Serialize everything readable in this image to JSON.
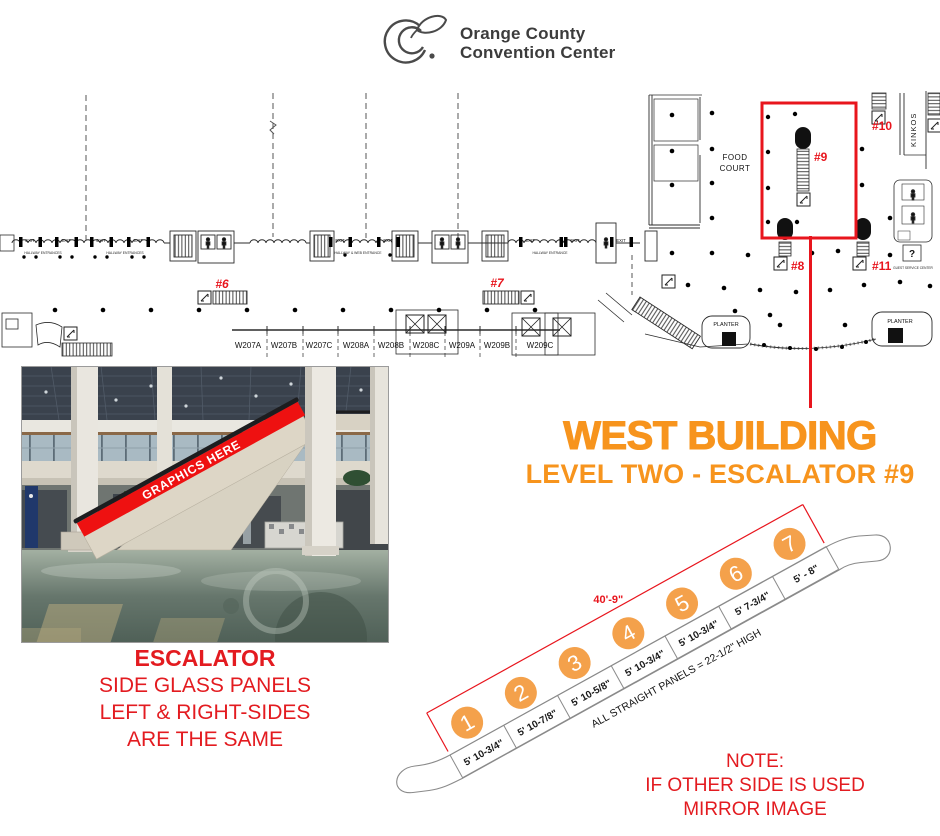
{
  "colors": {
    "orange_title": "#f7941d",
    "orange_circle": "#f4a14b",
    "red": "#e8151d",
    "stripe_red": "#ee1111",
    "plan_line": "#2b2b2b"
  },
  "logo": {
    "line1": "Orange County",
    "line2": "Convention Center"
  },
  "floor_plan": {
    "exit": "EXIT",
    "hallway1": "HALLWAY ENTRANCES",
    "hallway2": "HALLWAY & WEB ENTRANCE",
    "hallway3": "HALLWAY ENTRANCE",
    "food_court": [
      "FOOD",
      "COURT"
    ],
    "kinkos": "KINKOS",
    "planter": "PLANTER",
    "info": "?",
    "guest_services": "GUEST SERVICE CENTER",
    "rooms": [
      "W207A",
      "W207B",
      "W207C",
      "W208A",
      "W208B",
      "W208C",
      "W209A",
      "W209B",
      "W209C"
    ],
    "tags": {
      "e6": "#6",
      "e7": "#7",
      "e8": "#8",
      "e9": "#9",
      "e10": "#10",
      "e11": "#11"
    }
  },
  "title": {
    "heading": "WEST BUILDING",
    "subheading": "LEVEL TWO - ESCALATOR #9"
  },
  "photo": {
    "overlay_text": "GRAPHICS HERE"
  },
  "caption": [
    "ESCALATOR",
    "SIDE GLASS PANELS",
    "LEFT & RIGHT-SIDES",
    "ARE THE SAME"
  ],
  "note": [
    "NOTE:",
    "IF OTHER SIDE IS USED",
    "MIRROR IMAGE"
  ],
  "diagram": {
    "length_label": "40'-9\"",
    "height_note": "ALL STRAIGHT PANELS = 22-1/2\" HIGH",
    "panels": [
      {
        "num": "1",
        "width": "5' 10-3/4\""
      },
      {
        "num": "2",
        "width": "5' 10-7/8\""
      },
      {
        "num": "3",
        "width": "5' 10-5/8\""
      },
      {
        "num": "4",
        "width": "5' 10-3/4\""
      },
      {
        "num": "5",
        "width": "5' 10-3/4\""
      },
      {
        "num": "6",
        "width": "5' 7-3/4\""
      },
      {
        "num": "7",
        "width": "5' - 8\""
      }
    ]
  }
}
